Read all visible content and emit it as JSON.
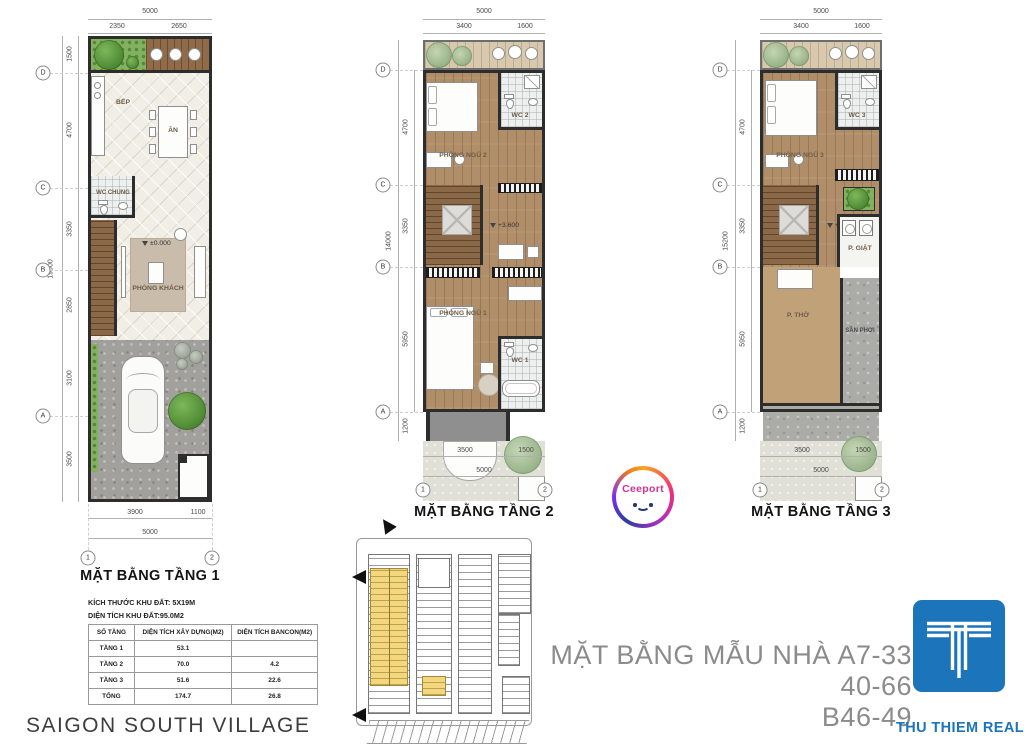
{
  "floor1": {
    "title": "MẶT BẰNG TẦNG 1",
    "rooms": {
      "bep": "BẾP",
      "an": "ĂN",
      "wc_chung": "WC CHUNG",
      "phong_khach": "PHÒNG KHÁCH"
    },
    "level": "±0.000",
    "dims": {
      "top_total": "5000",
      "top_segs": [
        "2350",
        "2650"
      ],
      "left_total": "19000",
      "left_segs": [
        "1500",
        "4700",
        "3350",
        "2850",
        "3100",
        "3500"
      ],
      "bottom_segs": [
        "3900",
        "1100"
      ],
      "bottom_total": "5000"
    },
    "grid_rows": [
      "D",
      "C",
      "B",
      "A"
    ],
    "grid_cols": [
      "1",
      "2"
    ]
  },
  "floor2": {
    "title": "MẶT BẰNG TẦNG 2",
    "rooms": {
      "ngu2": "PHÒNG NGỦ 2",
      "wc2": "WC 2",
      "ngu1": "PHÒNG NGỦ 1",
      "wc1": "WC 1"
    },
    "level": "+3.600",
    "dims": {
      "top_total": "5000",
      "top_segs": [
        "3400",
        "1600"
      ],
      "left_total": "14000",
      "left_segs": [
        "4700",
        "3350",
        "5950",
        "1200"
      ],
      "bottom_segs": [
        "3500",
        "1500"
      ],
      "bottom_total": "5000"
    },
    "grid_rows": [
      "D",
      "C",
      "B",
      "A"
    ],
    "grid_cols": [
      "1",
      "2"
    ]
  },
  "floor3": {
    "title": "MẶT BẰNG TẦNG 3",
    "rooms": {
      "ngu3": "PHÒNG NGỦ 3",
      "wc3": "WC 3",
      "giat": "P. GIẶT",
      "tho": "P. THỜ",
      "phoi": "SÂN PHƠI"
    },
    "level": "+7.000",
    "dims": {
      "top_total": "5000",
      "top_segs": [
        "3400",
        "1600"
      ],
      "left_total": "15200",
      "left_segs": [
        "4700",
        "3350",
        "5950",
        "1200"
      ],
      "bottom_segs": [
        "3500",
        "1500"
      ],
      "bottom_total": "5000"
    },
    "grid_rows": [
      "D",
      "C",
      "B",
      "A"
    ],
    "grid_cols": [
      "1",
      "2"
    ]
  },
  "info": {
    "land_size": "KÍCH THƯỚC KHU ĐẤT: 5X19M",
    "land_area": "DIỆN TÍCH KHU ĐẤT:95.0M2",
    "table": {
      "headers": [
        "SỐ TẦNG",
        "DIỆN TÍCH XÂY DỰNG(M2)",
        "DIỆN TÍCH BANCON(M2)"
      ],
      "rows": [
        {
          "c0": "TẦNG 1",
          "c1": "53.1",
          "c2": ""
        },
        {
          "c0": "TẦNG 2",
          "c1": "70.0",
          "c2": "4.2"
        },
        {
          "c0": "TẦNG 3",
          "c1": "51.6",
          "c2": "22.6"
        },
        {
          "c0": "TỔNG",
          "c1": "174.7",
          "c2": "26.8"
        }
      ]
    }
  },
  "footer": {
    "village": "SAIGON SOUTH VILLAGE",
    "caption1": "MẶT BẰNG MẪU NHÀ A7-33 40-66",
    "caption2": "B46-49",
    "brand": "THU THIEM REAL",
    "watermark": "Ceeport"
  }
}
